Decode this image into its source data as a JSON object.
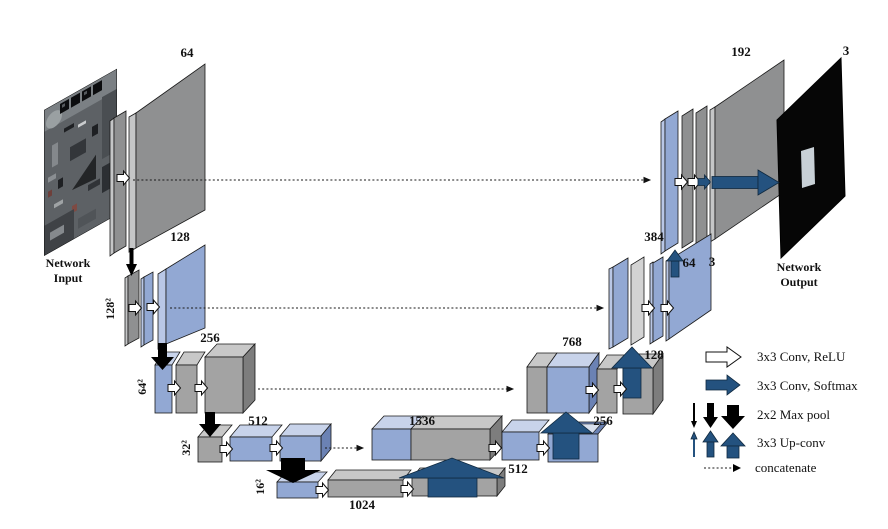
{
  "diagram": {
    "input": {
      "caption_line1": "Network",
      "caption_line2": "Input"
    },
    "output": {
      "caption_line1": "Network",
      "caption_line2": "Output",
      "channels": "3"
    },
    "encoder": {
      "level1_channels": "64",
      "level2_channels": "128",
      "level2_size": "128²",
      "level3_channels": "256",
      "level3_size": "64²",
      "level4_channels": "512",
      "level4_size": "32²",
      "level5_size": "16²",
      "bottleneck_channels": "1024"
    },
    "decoder": {
      "level4_concat_channels": "1536",
      "level4_conv_channels": "512",
      "level4_upconv_channels": "256",
      "level3_concat_channels": "768",
      "level3_upconv_channels": "128",
      "level2_concat_channels": "384",
      "level2_conv_channels": "64",
      "level2_out_channels": "3",
      "level1_concat_channels": "192"
    }
  },
  "legend": {
    "items": [
      {
        "icon": "white-right-arrow",
        "label": "3x3 Conv, ReLU"
      },
      {
        "icon": "navy-right-arrow",
        "label": "3x3 Conv, Softmax"
      },
      {
        "icon": "black-down-arrows",
        "label": "2x2 Max pool"
      },
      {
        "icon": "navy-up-arrows",
        "label": "3x3 Up-conv"
      },
      {
        "icon": "dotted-arrow",
        "label": "concatenate"
      }
    ]
  },
  "colors": {
    "box_blue": "#92a8d3",
    "box_blue_top": "#c8d3ea",
    "box_blue_side": "#6b82b4",
    "box_blue_light": "#b9c7e6",
    "box_gray": "#a3a3a3",
    "box_gray_top": "#c8c8c8",
    "box_gray_side": "#7d7d7d",
    "plane_gray": "#8f9091",
    "plane_gray_light": "#c5c6c7",
    "slab_lightgray": "#d3d3d3",
    "arrow_navy": "#24527f",
    "black": "#000000",
    "outline": "#1a1a1a"
  }
}
